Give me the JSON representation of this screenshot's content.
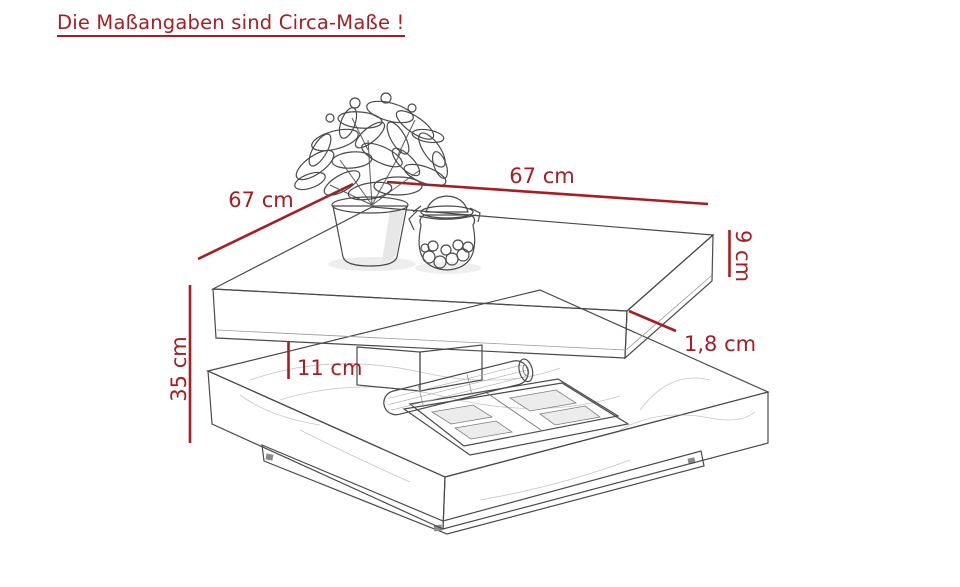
{
  "page": {
    "background": "#ffffff",
    "accent_red": "#a81c23",
    "line_art_color": "#4a4a4a"
  },
  "header": {
    "text": "Die Maßangaben sind Circa-Maße !"
  },
  "dimensions": {
    "width_left": "67 cm",
    "width_right": "67 cm",
    "top_height": "9 cm",
    "top_plate_thickness": "1,8 cm",
    "shelf_clearance": "11 cm",
    "total_height": "35 cm"
  }
}
